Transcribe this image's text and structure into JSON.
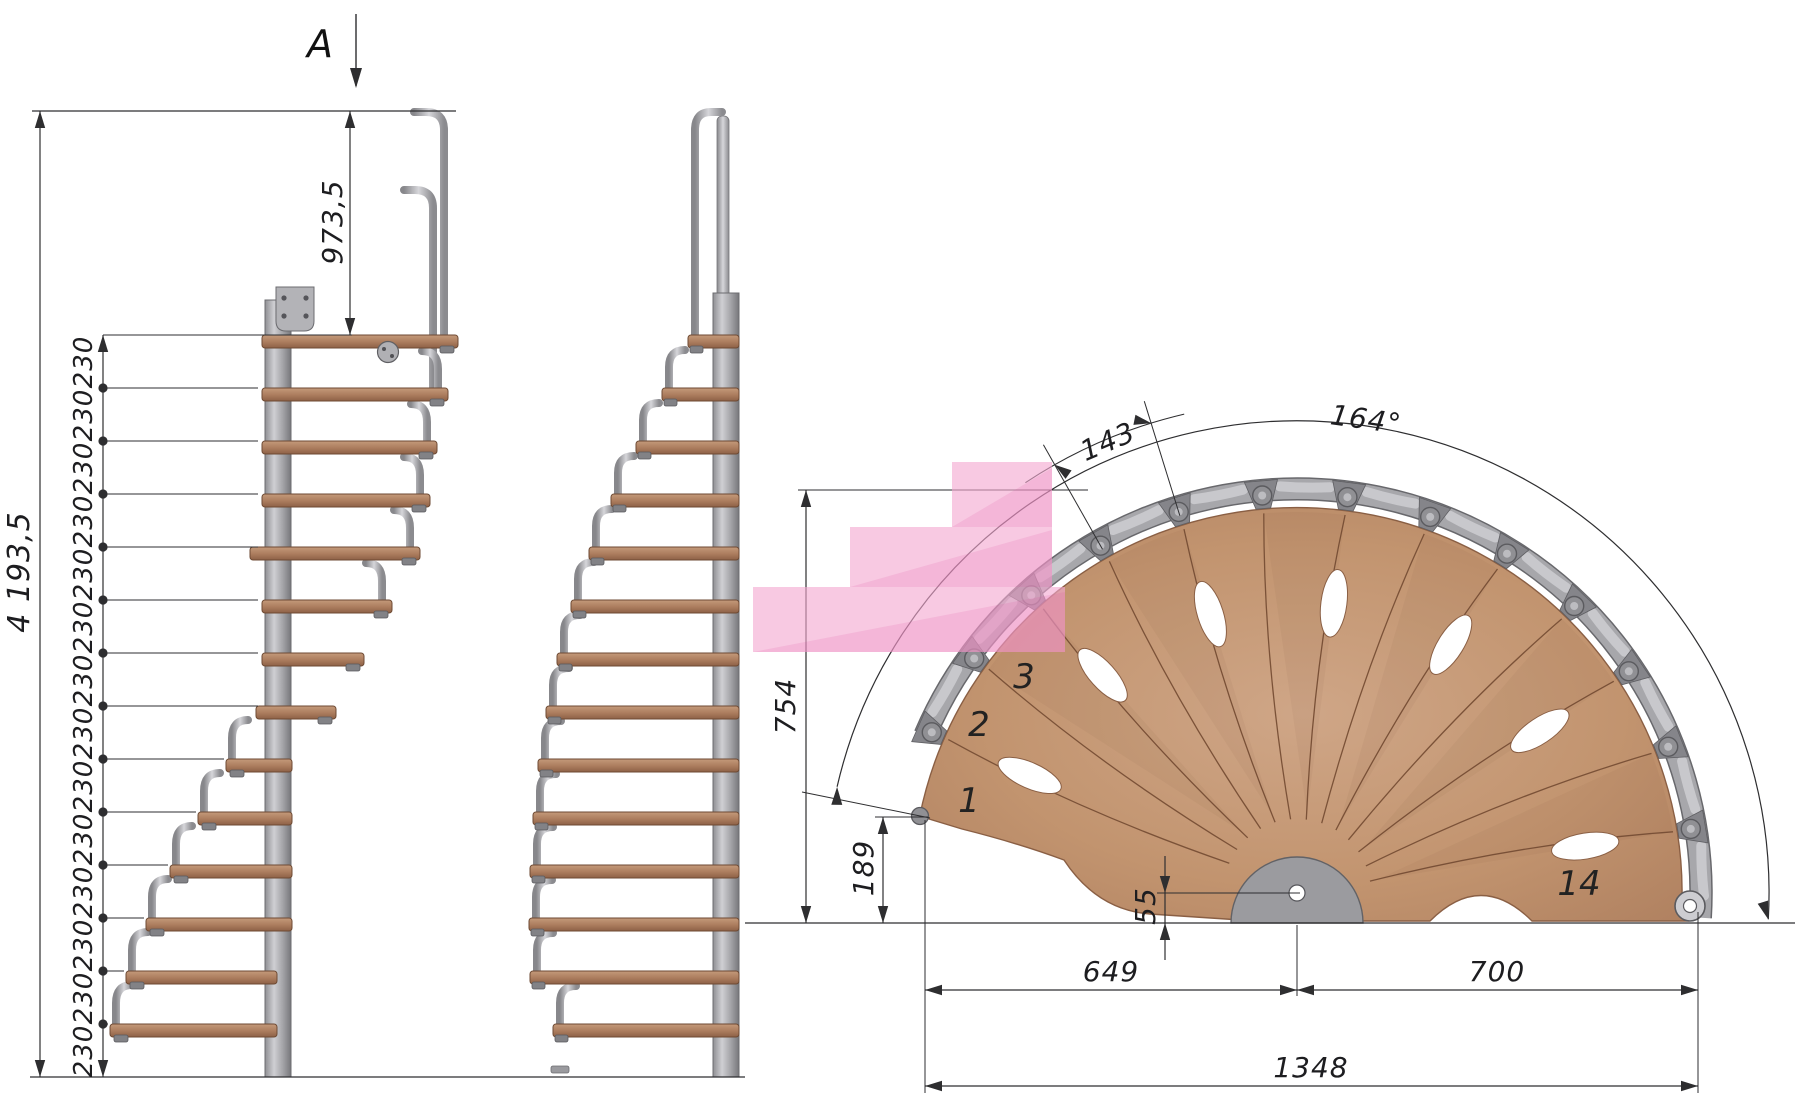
{
  "drawing": {
    "section_marker": "A",
    "elevation": {
      "total_height": "4 193,5",
      "top_rise": "973,5",
      "riser_label": "230",
      "riser_count": 14
    },
    "plan": {
      "tread_outer_width": "143",
      "sweep_angle": "164°",
      "left_height": "754",
      "first_tread_rise": "189",
      "base_offset": "55",
      "run_left": "649",
      "run_right": "700",
      "run_total": "1348",
      "tread_numbers": [
        "1",
        "2",
        "3",
        "14"
      ]
    },
    "colors": {
      "wood": "#BE9070",
      "metal": "#ADADB0",
      "highlight": "#F4A8D1",
      "line": "#2E2E30"
    }
  }
}
